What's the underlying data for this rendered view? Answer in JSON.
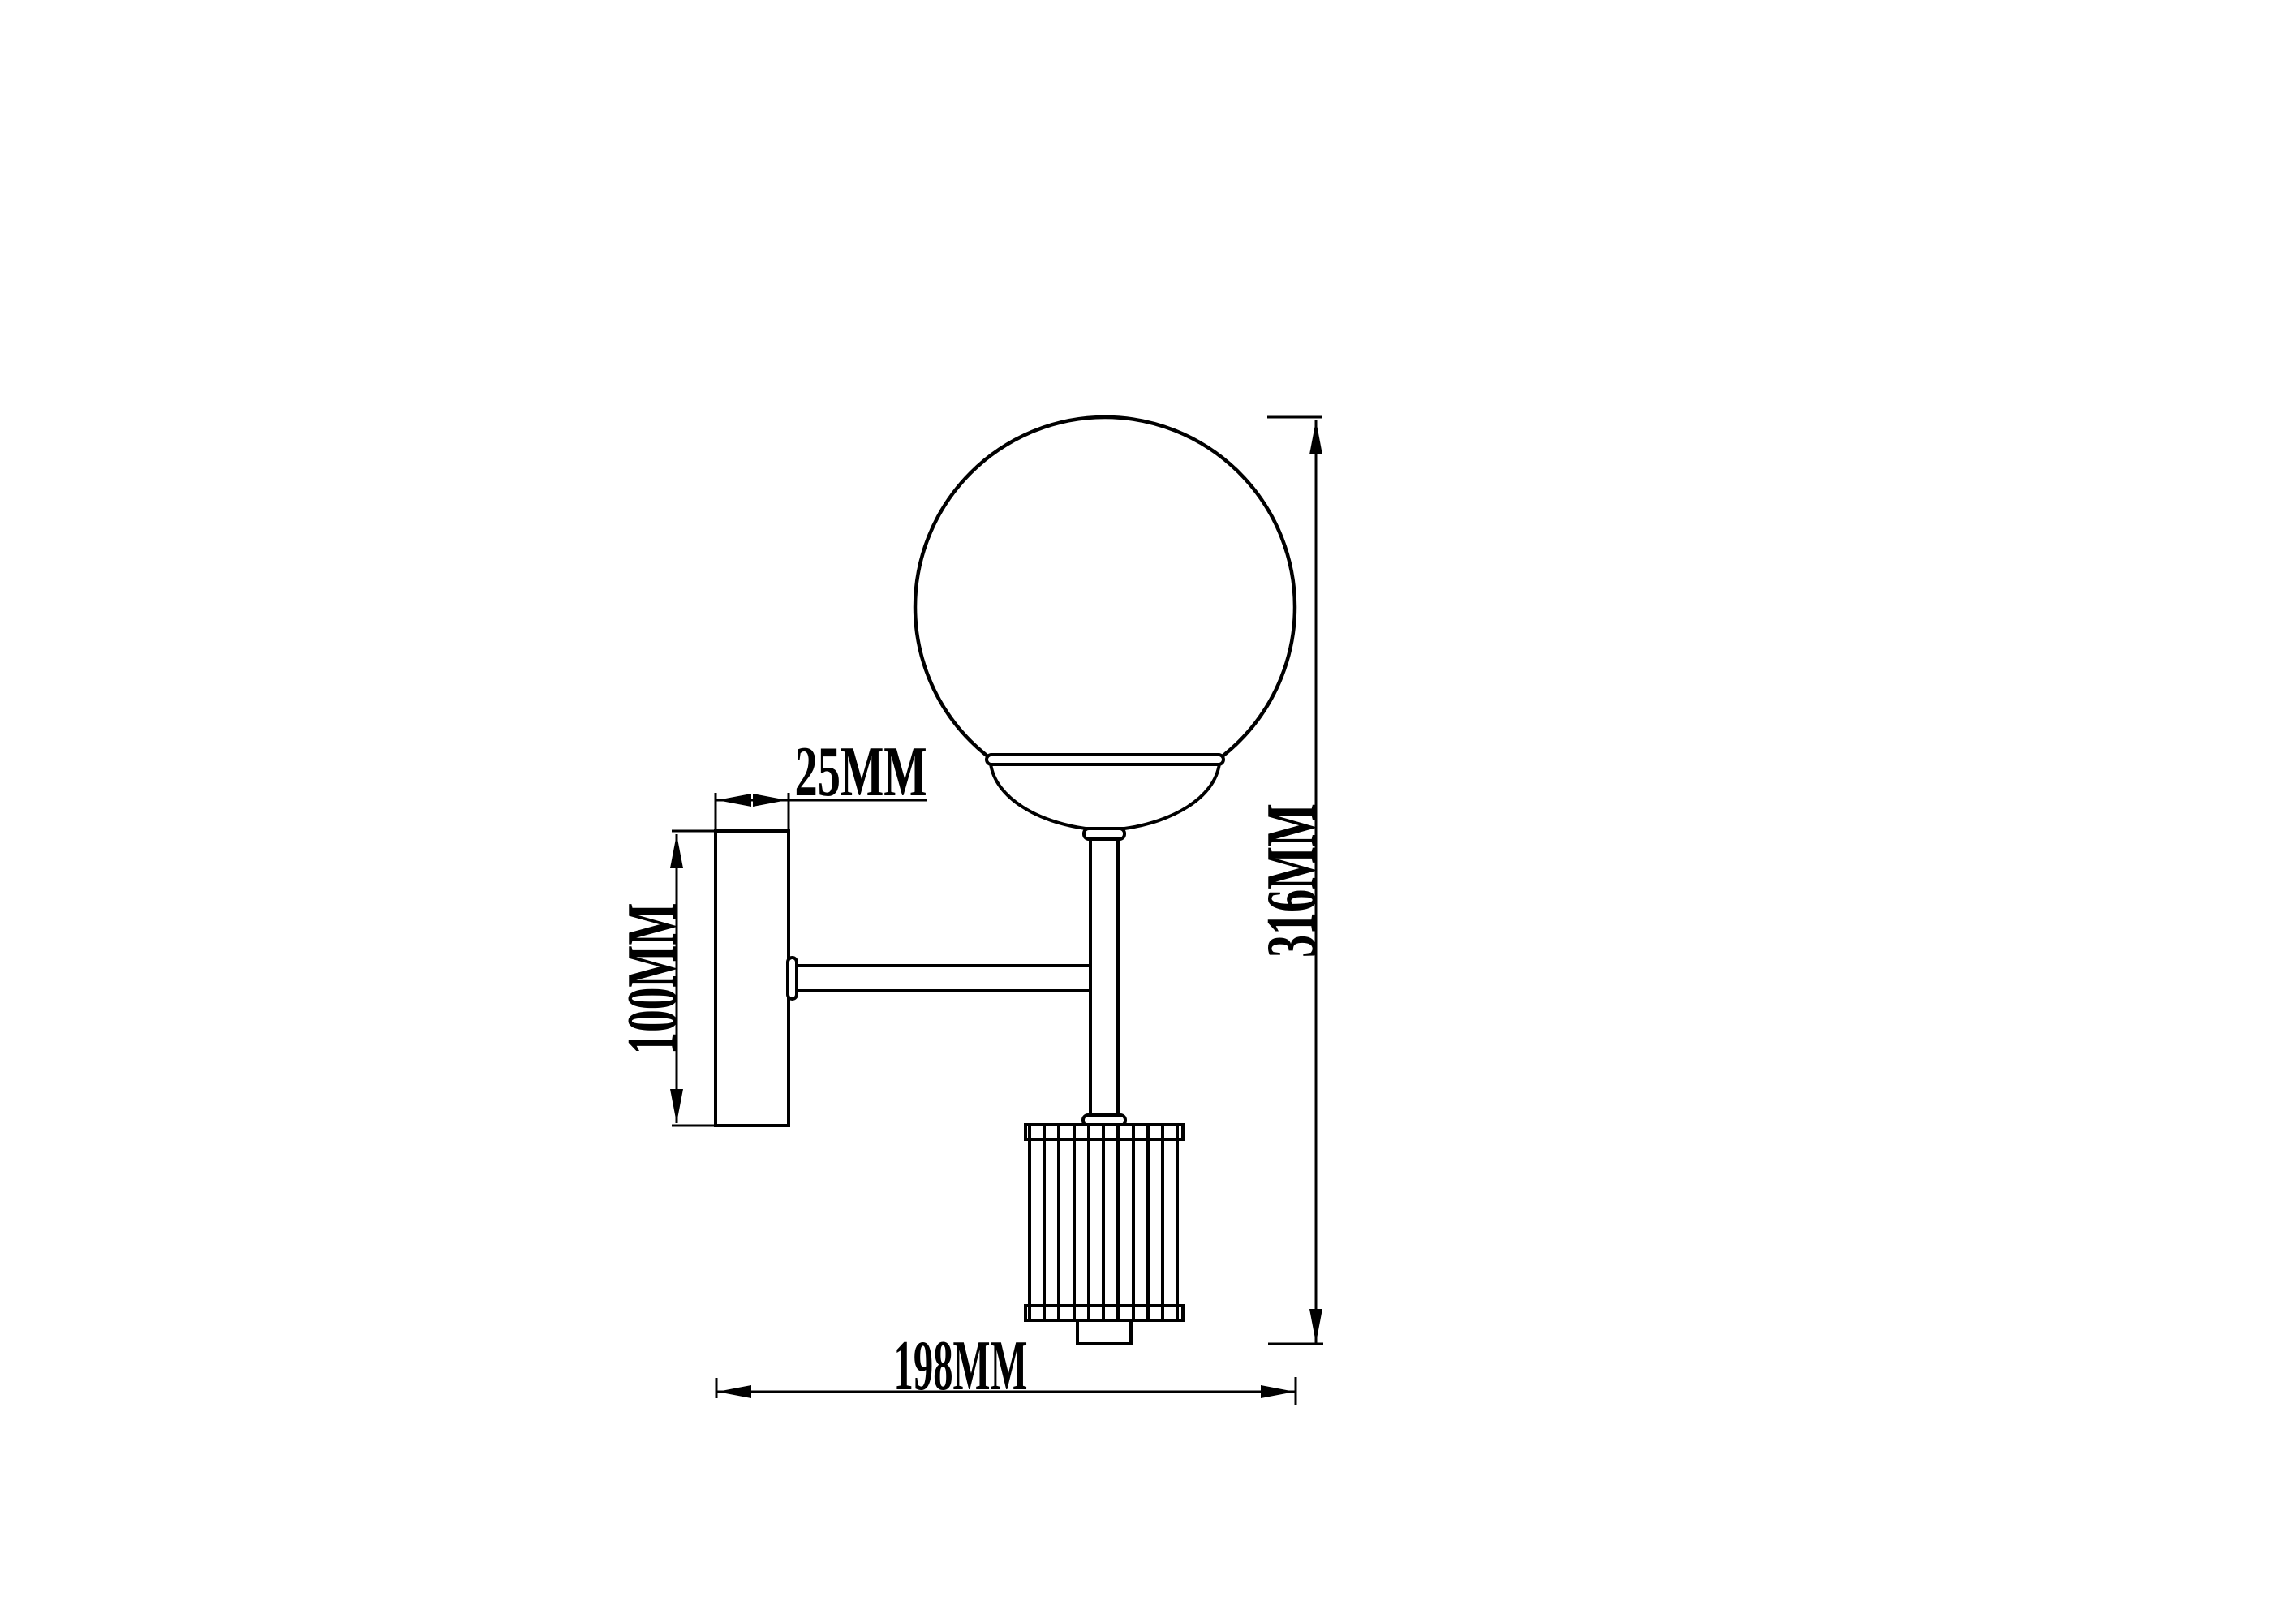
{
  "page": {
    "background": "#ffffff",
    "line_color": "#000000",
    "description": "Technical dimension drawing of a wall sconce: globe shade on a vertical stem with a ribbed crystal cylinder, mounted to a wall backplate by a horizontal arm."
  },
  "dimensions": {
    "plate_depth": {
      "label": "25MM",
      "value": 25,
      "unit": "MM"
    },
    "plate_height": {
      "label": "100MM",
      "value": 100,
      "unit": "MM"
    },
    "overall_height": {
      "label": "316MM",
      "value": 316,
      "unit": "MM"
    },
    "overall_projection": {
      "label": "198MM",
      "value": 198,
      "unit": "MM"
    }
  }
}
